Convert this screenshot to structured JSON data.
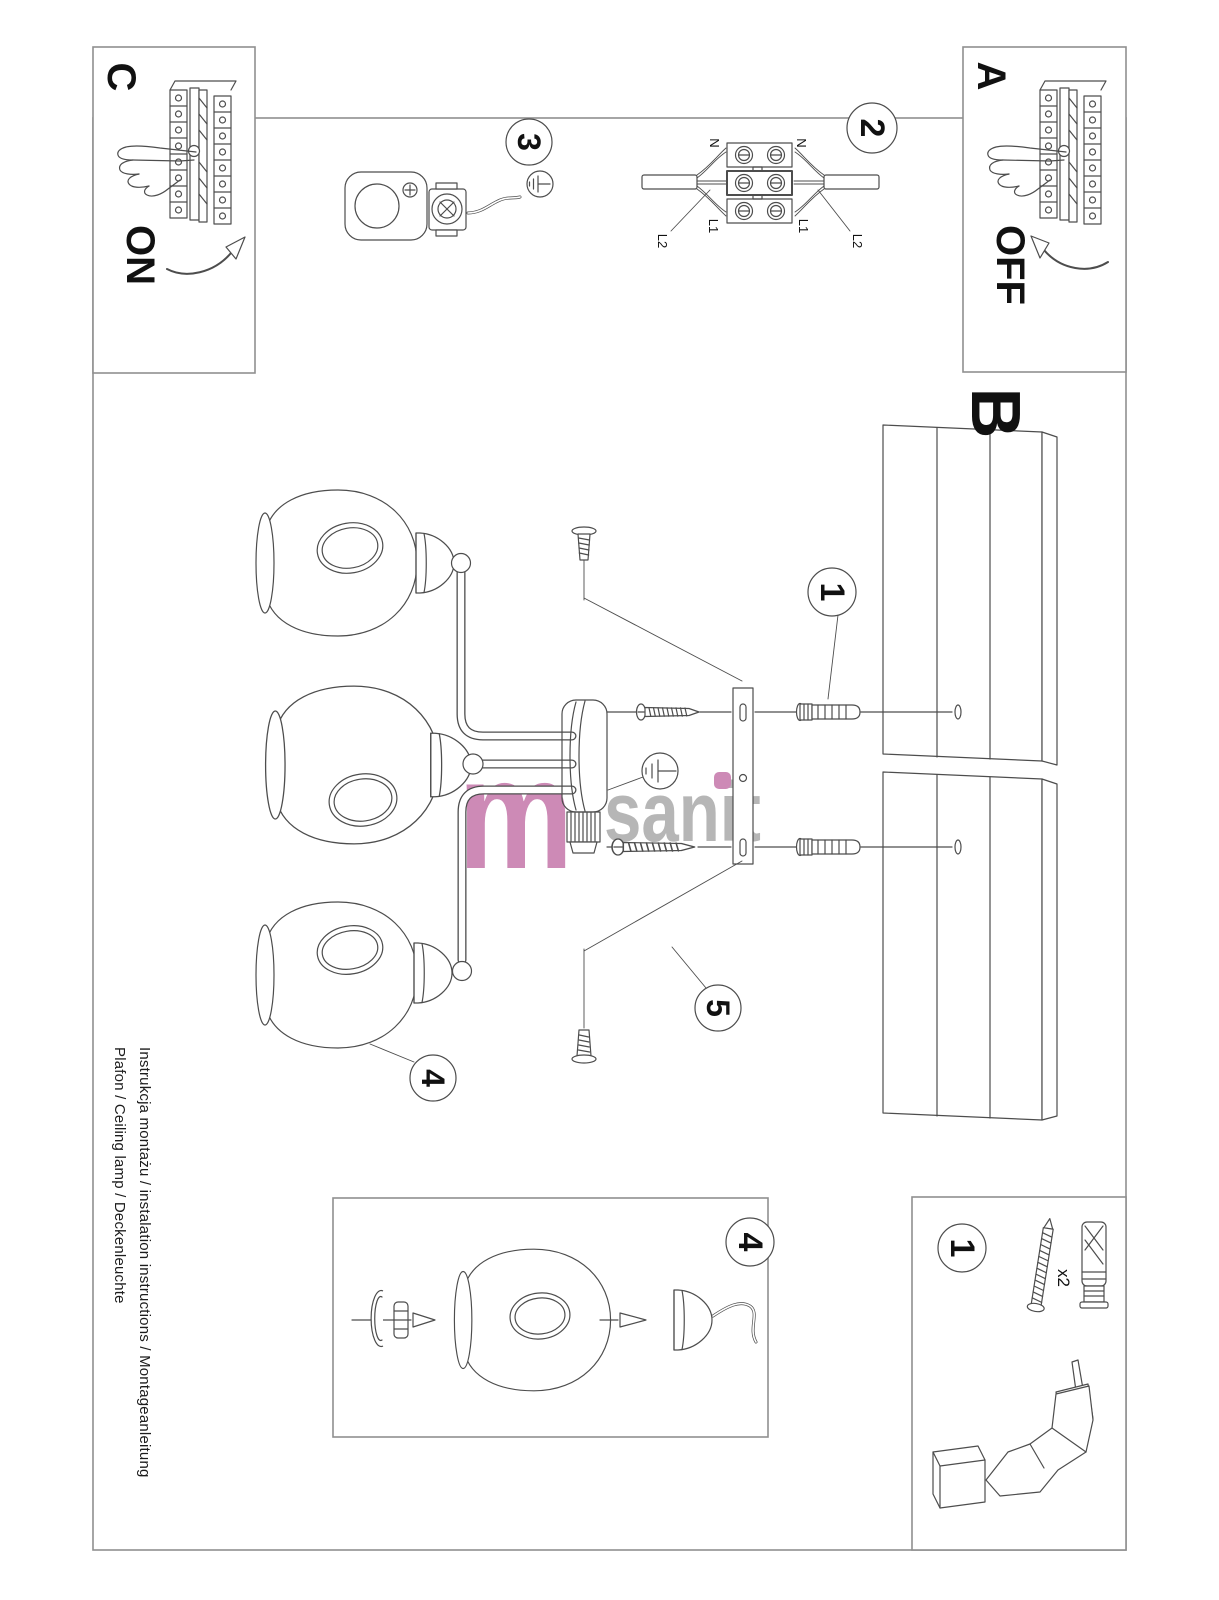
{
  "footer": {
    "line1": "Instrukcja montażu / instalation instructions / Montageanleitung",
    "line2": "Plafon / Ceiling lamp / Deckenleuchte"
  },
  "sections": {
    "a": "A",
    "b": "B",
    "c": "C"
  },
  "switch_labels": {
    "on": "ON",
    "off": "OFF"
  },
  "steps": {
    "one": "1",
    "two": "2",
    "three": "3",
    "four": "4",
    "five": "5"
  },
  "wiring_labels": {
    "n": "N",
    "l1": "L1",
    "l2": "L2"
  },
  "hardware": {
    "quantity": "x2"
  },
  "watermark": {
    "m": "m",
    "rest": "sanit"
  },
  "colors": {
    "watermark_pink": "#cd8ab6",
    "watermark_gray": "#b6b6b6",
    "line": "#4d4d4d",
    "frame": "#8f8f8f"
  }
}
